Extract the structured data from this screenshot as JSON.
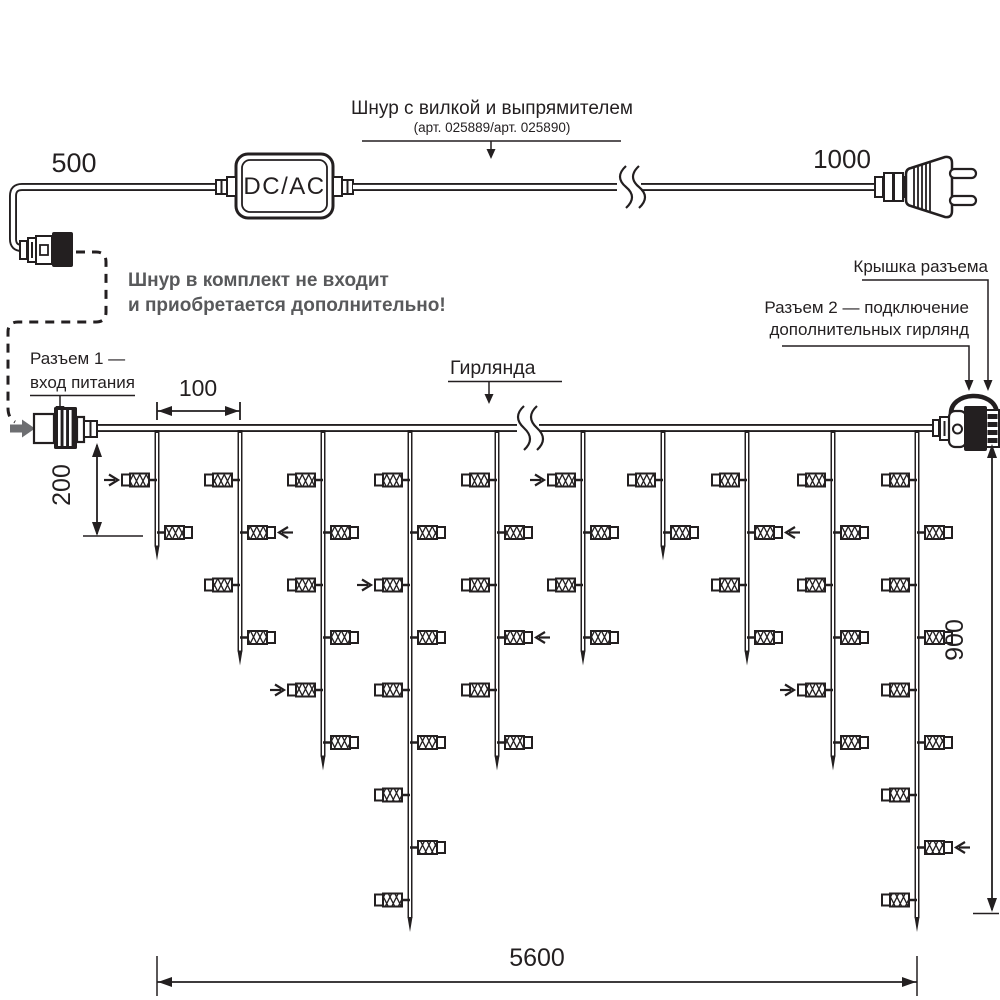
{
  "diagram": {
    "cord": {
      "title": "Шнур с вилкой и выпрямителем",
      "subtitle": "(арт. 025889/арт. 025890)",
      "left_length": "500",
      "right_length": "1000",
      "converter_label": "DC/AC"
    },
    "note": {
      "line1": "Шнур в комплект не входит",
      "line2": "и приобретается дополнительно!"
    },
    "labels": {
      "connector1_line1": "Разъем 1 —",
      "connector1_line2": "вход питания",
      "garland": "Гирлянда",
      "cap": "Крышка разъема",
      "connector2_line1": "Разъем 2 — подключение",
      "connector2_line2": "дополнительных гирлянд"
    },
    "dimensions": {
      "drop_spacing": "100",
      "first_drop_length": "200",
      "garland_height": "900",
      "garland_length": "5600"
    },
    "colors": {
      "line": "#231F20",
      "note_gray": "#58595B",
      "arrow_gray": "#6D6E71"
    },
    "garland": {
      "wire_y": 428,
      "wire_x1": 95,
      "wire_x2": 933,
      "row_start_y": 480,
      "row_spacing": 52.5,
      "drops": [
        {
          "x": 157,
          "lamps": 2,
          "arrow_row": 1
        },
        {
          "x": 240,
          "lamps": 4,
          "arrow_row": 2
        },
        {
          "x": 323,
          "lamps": 6,
          "arrow_row": 5
        },
        {
          "x": 410,
          "lamps": 9,
          "arrow_row": 3
        },
        {
          "x": 497,
          "lamps": 6,
          "arrow_row": 4
        },
        {
          "x": 583,
          "lamps": 4,
          "arrow_row": 1
        },
        {
          "x": 663,
          "lamps": 2,
          "arrow_row": null
        },
        {
          "x": 747,
          "lamps": 4,
          "arrow_row": 2
        },
        {
          "x": 833,
          "lamps": 6,
          "arrow_row": 5
        },
        {
          "x": 917,
          "lamps": 9,
          "arrow_row": 8
        }
      ]
    }
  }
}
